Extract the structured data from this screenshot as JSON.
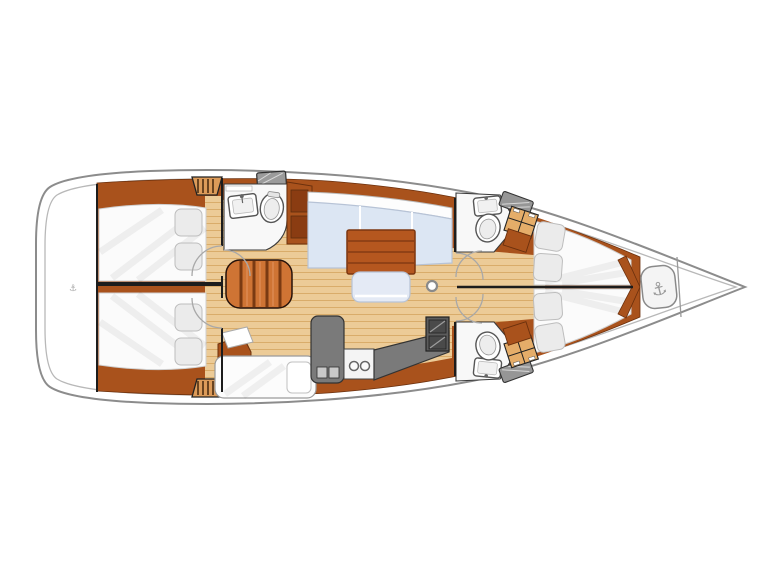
{
  "title": "",
  "palette": {
    "hull_fill": "#ffffff",
    "hull_stroke": "#8c8c8c",
    "inner_line": "#b8b8b8",
    "wood_trim": "#a9521c",
    "wood_trim_dark": "#6b300d",
    "floor": "#eccb97",
    "floor_line": "#d9ac6a",
    "step_light": "#cf7434",
    "step_dark": "#7a3a12",
    "settee": "#dce6f3",
    "settee_edge": "#b7c3d6",
    "upholstery_white": "#fbfbfb",
    "pillow": "#ebebeb",
    "pillow_edge": "#bdbdbd",
    "counter": "#7a7a7a",
    "counter_dark": "#5c5c5c",
    "appliance": "#9b9b9b",
    "wall": "#1c1c1c",
    "door_arc": "#a8a8a8",
    "fixture_stroke": "#555555",
    "wardrobe": "#e5ad69",
    "table": "#b5571f",
    "table_line": "#7c3710",
    "anchor": "#9a9a9a"
  },
  "icons": {
    "windlass": "⚓",
    "stern_marker": "⚓"
  },
  "features": [
    "swim-platform",
    "aft-cabin-port",
    "aft-cabin-starboard",
    "aft-head",
    "companionway-steps",
    "saloon-settee",
    "saloon-table",
    "galley",
    "nav-station",
    "forward-head-port",
    "forward-head-starboard",
    "forward-cabin-port",
    "forward-cabin-starboard",
    "anchor-locker",
    "mast"
  ]
}
